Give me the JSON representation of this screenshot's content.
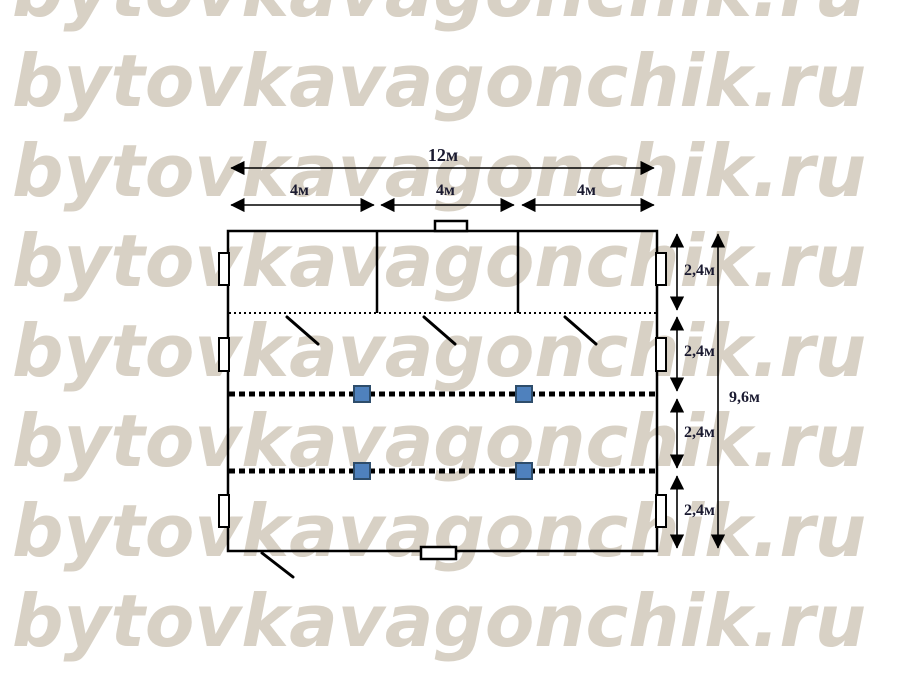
{
  "watermark": {
    "text": "bytovkavagonchik.ru",
    "color": "#d8d1c5",
    "rows": 8
  },
  "diagram": {
    "kind": "modular-building-floor-plan",
    "top_dims": {
      "total": "12м",
      "segments": [
        "4м",
        "4м",
        "4м"
      ]
    },
    "right_dims": {
      "segments": [
        "2,4м",
        "2,4м",
        "2,4м",
        "2,4м"
      ],
      "total": "9,6м"
    },
    "colors": {
      "line": "#000000",
      "dim_text": "#1a1a30",
      "column_fill": "#4f81bd",
      "column_border": "#2e4d6b",
      "watermark": "#d8d1c5"
    }
  }
}
